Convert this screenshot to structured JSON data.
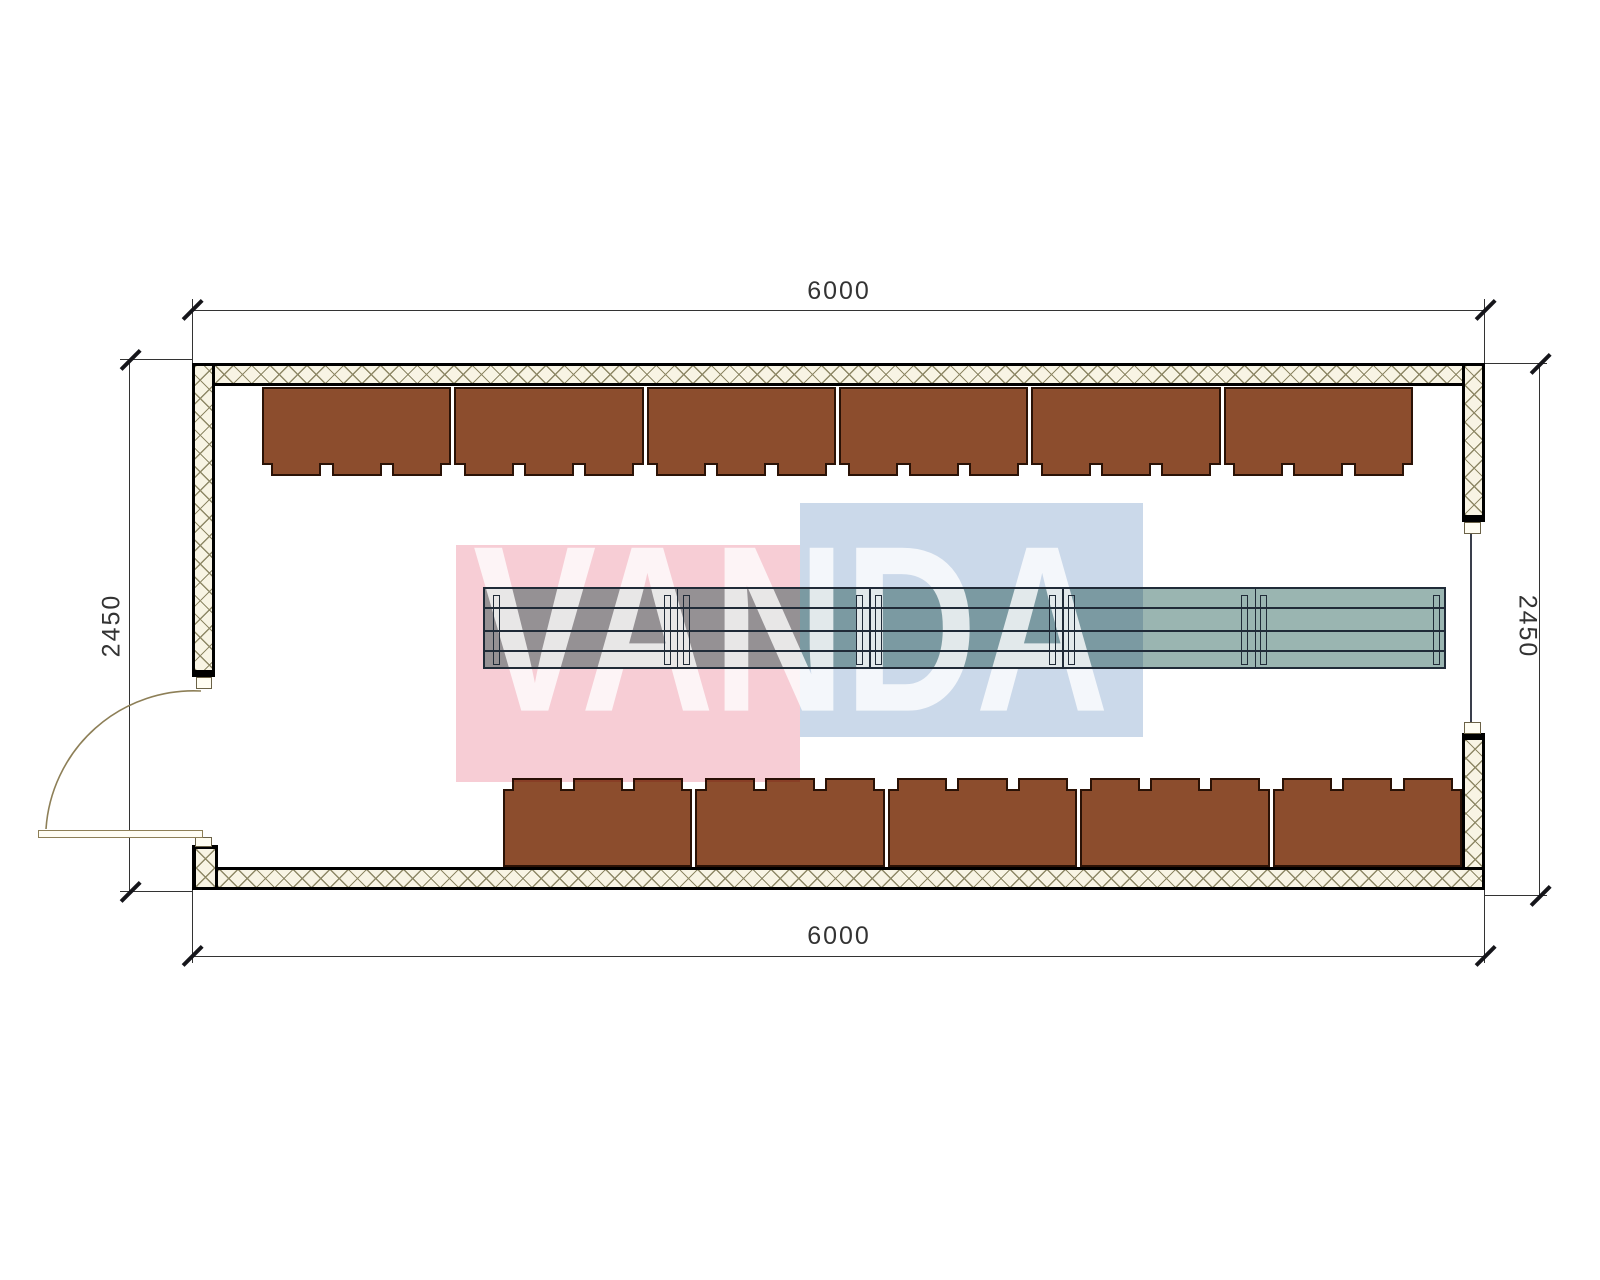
{
  "drawing": {
    "type": "floor-plan",
    "dimensions": {
      "top": "6000",
      "bottom": "6000",
      "left": "2450",
      "right": "2450"
    },
    "watermark": {
      "text": "VANDA"
    },
    "furniture": {
      "top_desk_count": 6,
      "bottom_desk_count": 5,
      "tabs_per_desk": 3,
      "table_section_count": 5
    },
    "colors": {
      "hatch_bg": "#f8f4e4",
      "hatch_line": "#8e8866",
      "wall_line": "#000000",
      "desk_fill": "#8c4d2d",
      "desk_border": "#2a1206",
      "table_fill": "#9ab5b1",
      "table_line": "#202b38",
      "pink": "#f7cdd5",
      "blue": "#cbd9ea",
      "dim": "#333333",
      "door": "#8d7f57"
    }
  }
}
